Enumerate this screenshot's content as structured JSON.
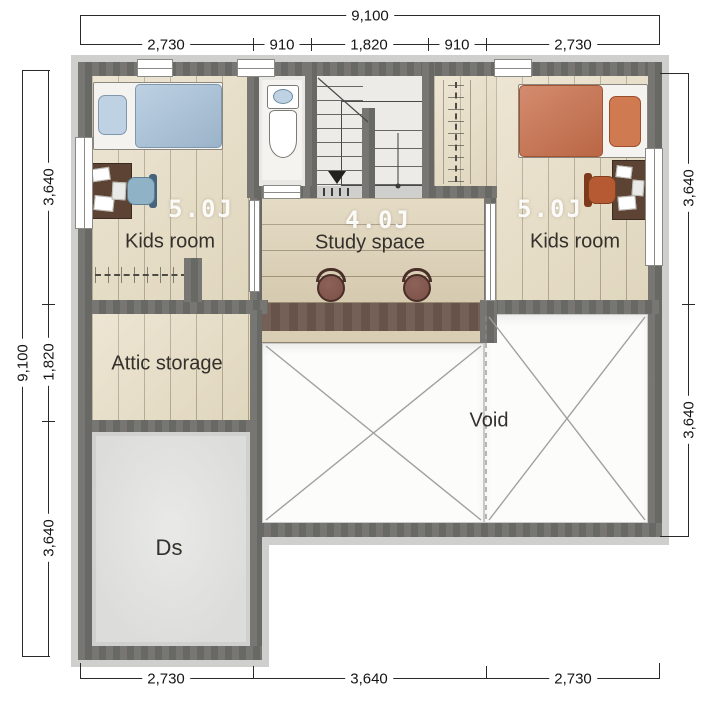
{
  "title": "Second floor plan",
  "rooms": {
    "kids_left": {
      "size": "5.0J",
      "name": "Kids room"
    },
    "kids_right": {
      "size": "5.0J",
      "name": "Kids room"
    },
    "study": {
      "size": "4.0J",
      "name": "Study space"
    },
    "attic": {
      "name": "Attic storage"
    },
    "ds": {
      "name": "Ds"
    },
    "void": {
      "name": "Void"
    }
  },
  "dims": {
    "top_total": "9,100",
    "top_segments": [
      "2,730",
      "910",
      "1,820",
      "910",
      "2,730"
    ],
    "bottom_segments": [
      "2,730",
      "3,640",
      "2,730"
    ],
    "left_total": "9,100",
    "left_segments": [
      "3,640",
      "1,820",
      "3,640"
    ],
    "right_segments": [
      "3,640",
      "3,640"
    ]
  },
  "colors": {
    "wall": "#6f6e6a",
    "wood_floor": "#e7ddc4",
    "study_floor": "#ded2b6",
    "counter": "#6d584e",
    "counter_edge": "#d9cdb4",
    "bed_blue": "#a7c1d9",
    "pillow_blue": "#bed2e4",
    "bed_orange": "#c96f4a",
    "pillow_orange": "#d07a52",
    "chair_blue": "#8fb2c6",
    "chair_orange": "#b55a33",
    "desk_brown": "#5d4334",
    "stool_brown": "#7a5148",
    "ds_floor": "#dcdcda",
    "toilet_floor": "#e9e8e4",
    "stairs_floor": "#edebe7",
    "void_floor": "#fcfcfb",
    "dim_text": "#151515"
  }
}
